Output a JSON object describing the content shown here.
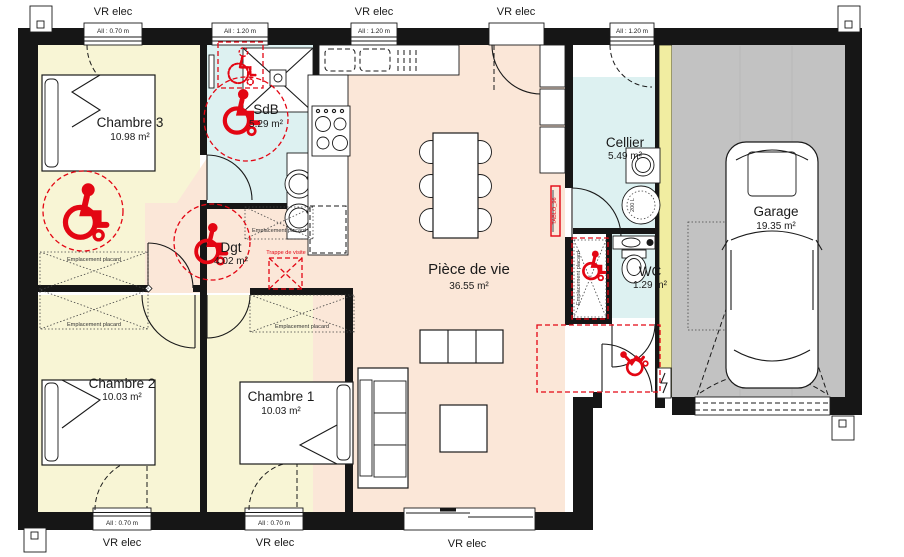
{
  "plan": {
    "title": "floor-plan",
    "rooms": [
      {
        "key": "chambre3",
        "name": "Chambre 3",
        "area": "10.98 m²"
      },
      {
        "key": "sdb",
        "name": "SdB",
        "area": "5.29 m²"
      },
      {
        "key": "dgt",
        "name": "Dgt",
        "area": "4.02 m²"
      },
      {
        "key": "piece_de_vie",
        "name": "Pièce de vie",
        "area": "36.55 m²"
      },
      {
        "key": "cellier",
        "name": "Cellier",
        "area": "5.49 m²"
      },
      {
        "key": "wc",
        "name": "WC",
        "area": "1.29 m²"
      },
      {
        "key": "garage",
        "name": "Garage",
        "area": "19.35 m²"
      },
      {
        "key": "chambre2",
        "name": "Chambre 2",
        "area": "10.03 m²"
      },
      {
        "key": "chambre1",
        "name": "Chambre 1",
        "area": "10.03 m²"
      }
    ],
    "windows": [
      {
        "id": "top-1",
        "sill": "All : 0.70 m"
      },
      {
        "id": "top-2",
        "sill": "All : 1.20 m"
      },
      {
        "id": "top-3",
        "sill": "All : 1.20 m"
      },
      {
        "id": "top-cellier",
        "sill": "All : 1.20 m"
      },
      {
        "id": "bottom-1",
        "sill": "All : 0.70 m"
      },
      {
        "id": "bottom-2",
        "sill": "All : 0.70 m"
      }
    ],
    "labels": {
      "vr_elec": "VR elec",
      "emplacement_placard": "Emplacement placard",
      "trappe_de_visite": "Trappe de visite",
      "tablo": "TABLO_96",
      "water_heater": "200 L"
    },
    "colors": {
      "bedroom_floor": "#f8f5d5",
      "wet_room_floor": "#ddf1f1",
      "living_floor": "#fbe7d8",
      "garage_floor": "#c2c2c2",
      "partition_yellow": "#f1eda1",
      "wall": "#161616",
      "accessibility_red": "#e30613"
    }
  }
}
